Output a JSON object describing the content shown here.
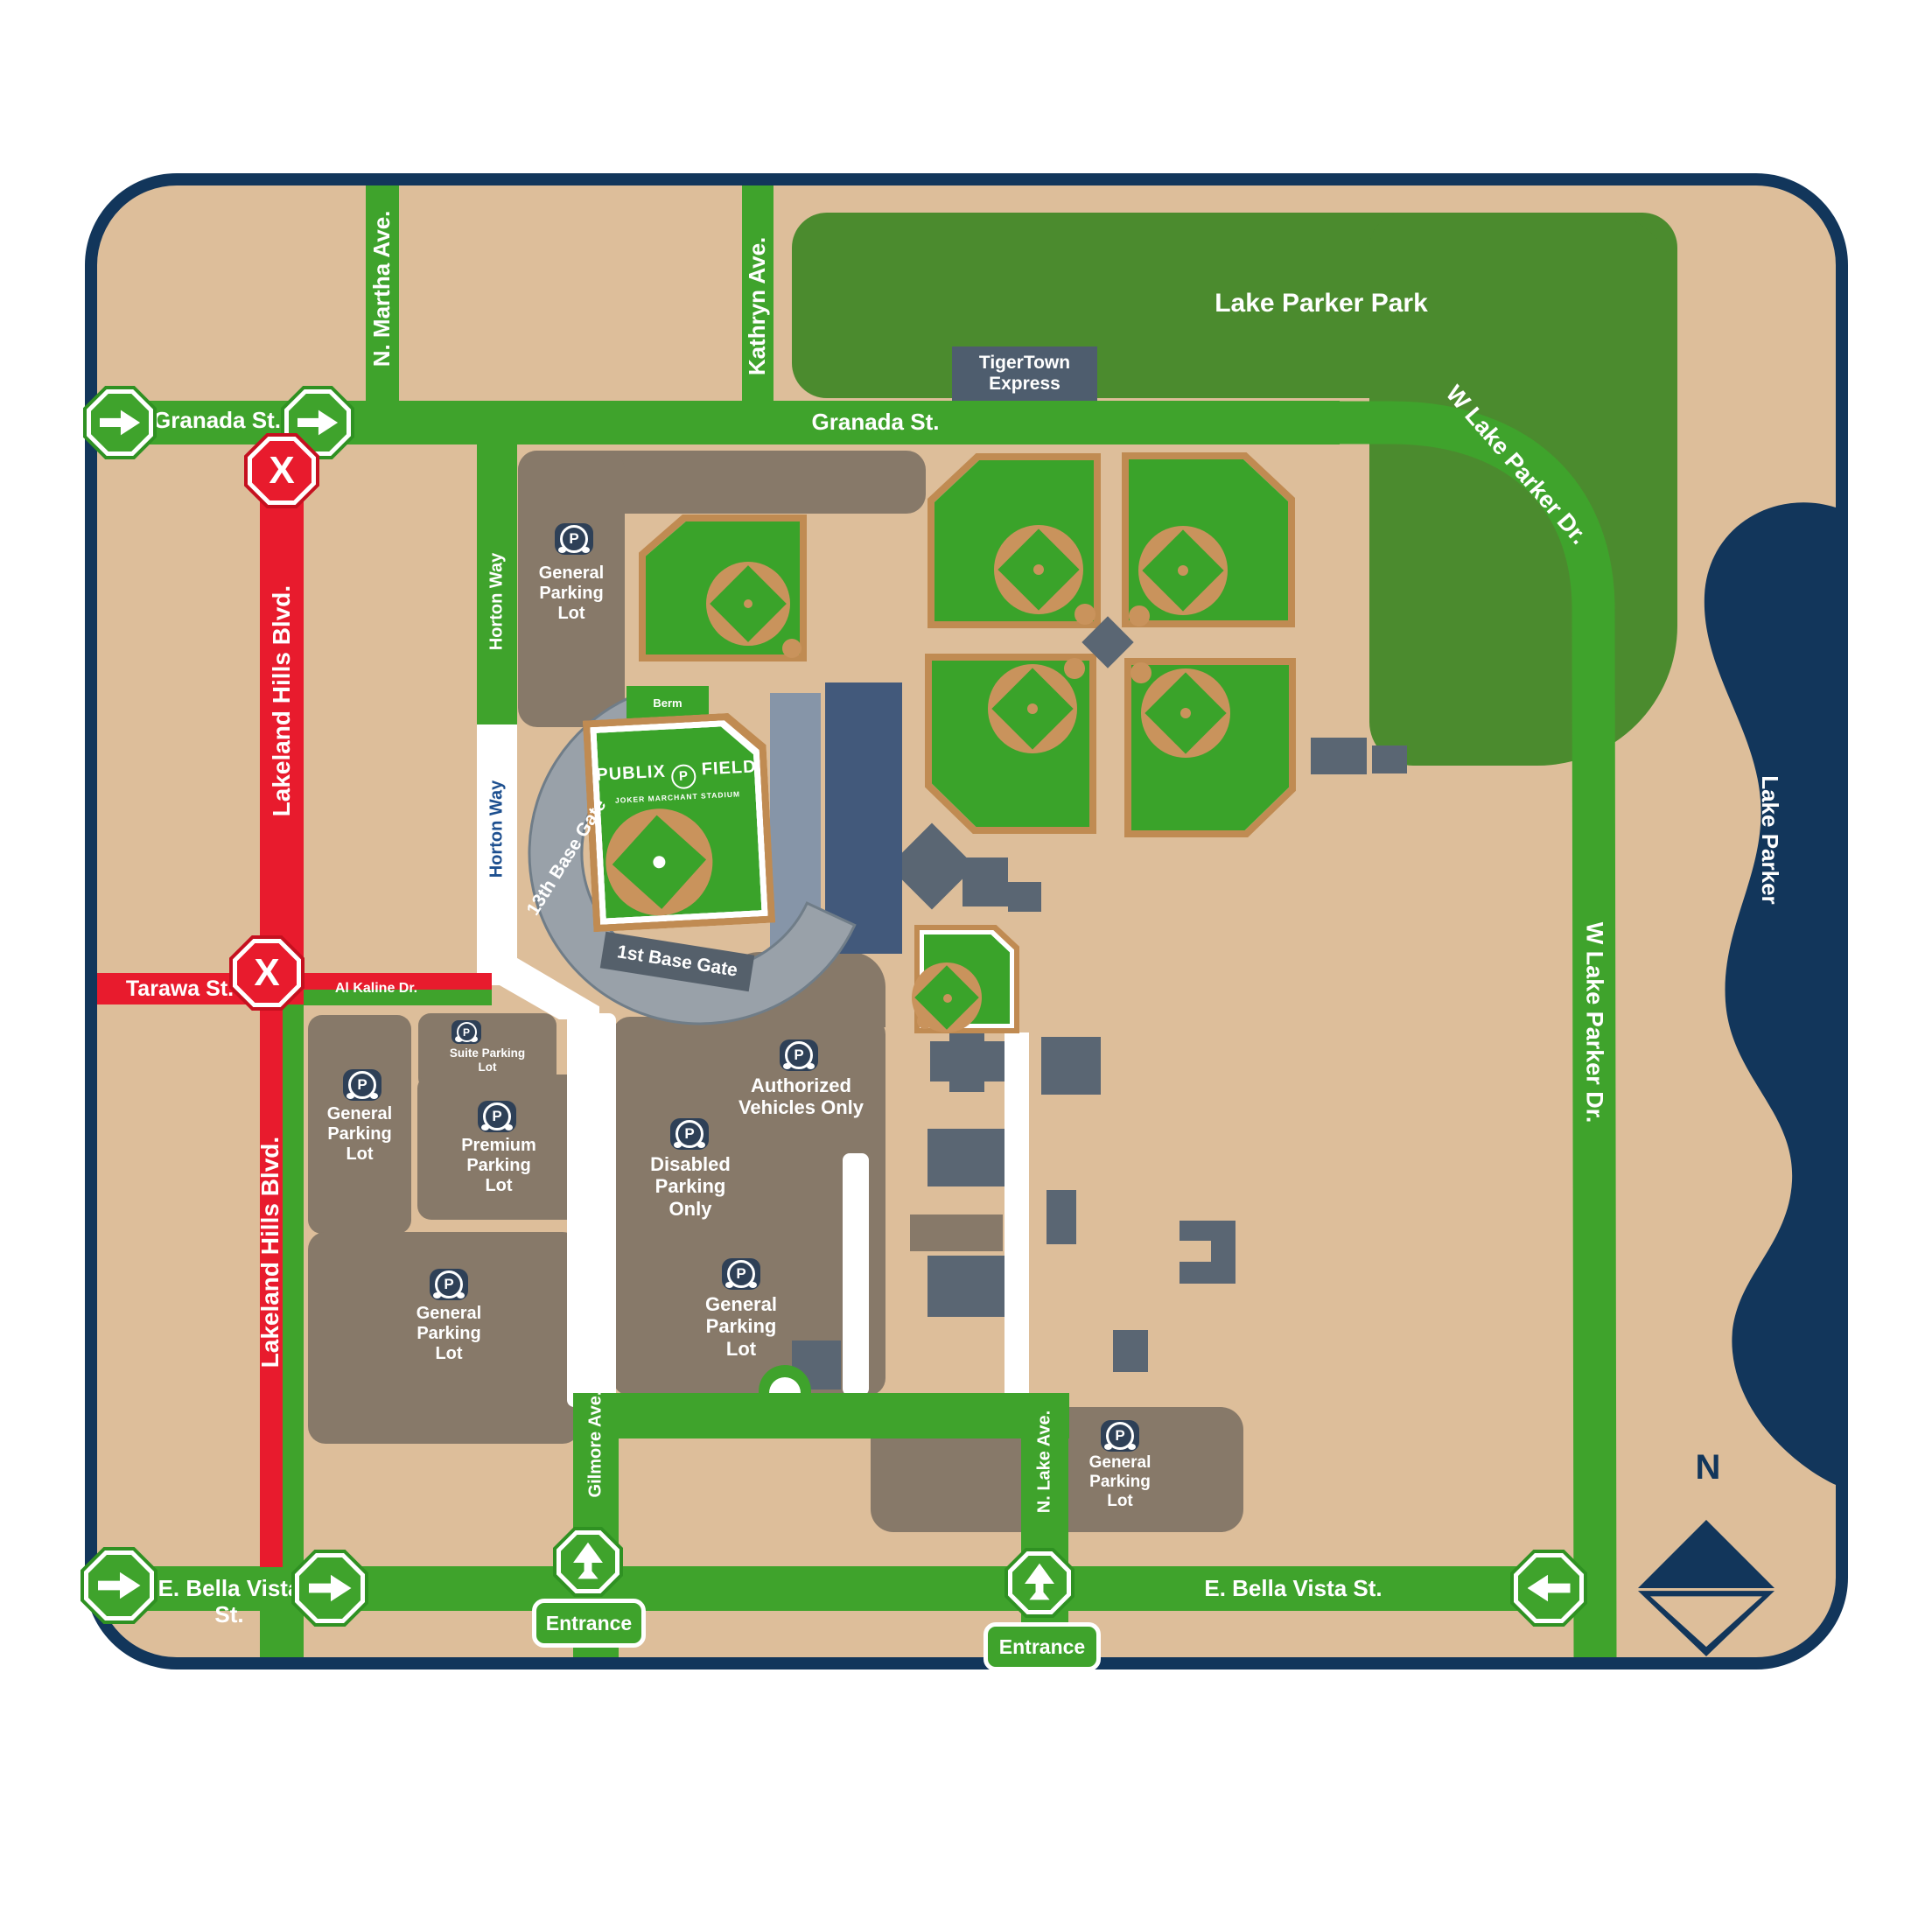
{
  "title": "Publix Field at Joker Marchant Stadium parking map",
  "streets": {
    "granada": "Granada St.",
    "martha": "N. Martha Ave.",
    "kathryn": "Kathryn Ave.",
    "wlakeparker": "W Lake Parker Dr.",
    "lakeland": "Lakeland Hills Blvd.",
    "tarawa": "Tarawa St.",
    "alkaline": "Al Kaline Dr.",
    "horton": "Horton Way",
    "gilmore": "Gilmore Ave.",
    "nlake": "N. Lake Ave.",
    "bellavista": "E. Bella Vista St."
  },
  "landmarks": {
    "park": "Lake Parker Park",
    "lake": "Lake Parker",
    "tigertown": "TigerTown\nExpress",
    "berm": "Berm",
    "compass_n": "N"
  },
  "stadium": {
    "logo_left": "PUBLIX",
    "logo_p": "P",
    "logo_right": "FIELD",
    "logo_sub": "JOKER MARCHANT STADIUM",
    "gate_first": "1st Base Gate",
    "gate_third": "13th Base Gate"
  },
  "lots": {
    "general": "General\nParking\nLot",
    "premium": "Premium\nParking\nLot",
    "suite": "Suite Parking\nLot",
    "disabled": "Disabled\nParking\nOnly",
    "authorized": "Authorized\nVehicles Only"
  },
  "signs": {
    "entrance": "Entrance",
    "closed_x": "X"
  },
  "colors": {
    "open_road_green": "#3FA32C",
    "closed_road_red": "#E81B2D",
    "navy": "#12365B",
    "park_green": "#4B8B2E",
    "field_green": "#3AA32A",
    "ground_tan": "#DDBE9A",
    "lot_brown": "#877969",
    "building_slate": "#5A6673",
    "infield_tan": "#C9935C"
  }
}
